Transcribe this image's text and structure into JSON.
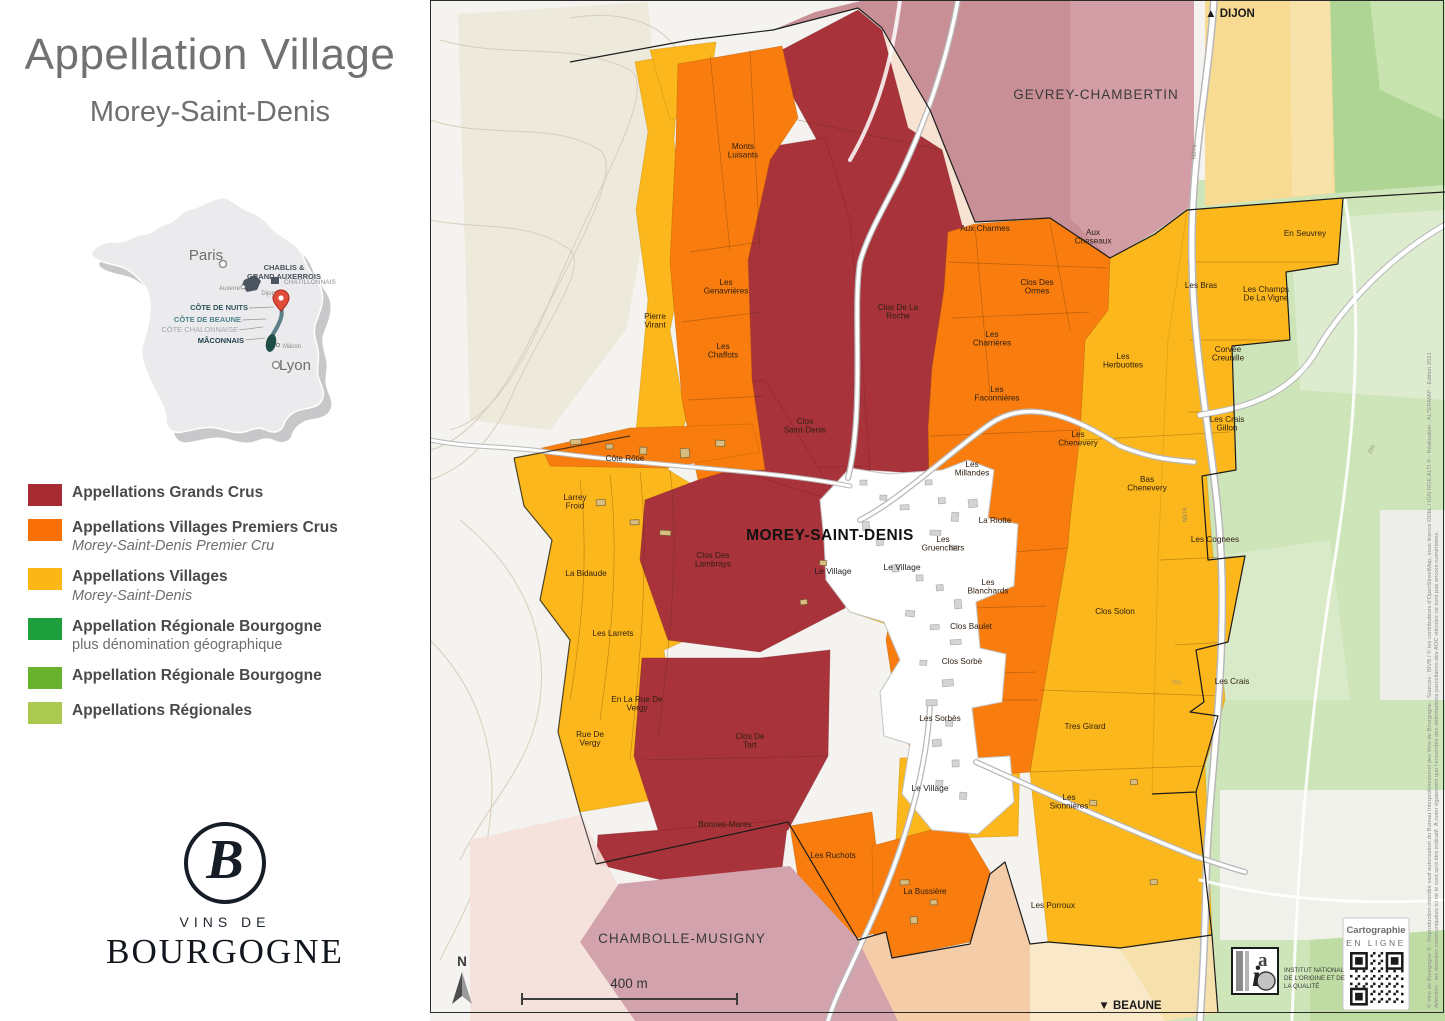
{
  "panel": {
    "title": "Appellation Village",
    "subtitle": "Morey-Saint-Denis",
    "france_map": {
      "labels": {
        "paris": "Paris",
        "lyon": "Lyon",
        "auxerre": "Auxerre",
        "dijon": "Dijon",
        "macon": "Mâcon",
        "chablis_1": "CHABLIS &",
        "chablis_2": "GRAND AUXERROIS",
        "chatillonnais": "CHÂTILLONNAIS",
        "cote_de_nuits": "CÔTE DE NUITS",
        "cote_de_beaune": "CÔTE DE BEAUNE",
        "cote_chalonnaise": "CÔTE CHALONNAISE",
        "maconnais": "MÂCONNAIS"
      }
    },
    "legend": {
      "items": [
        {
          "label": "Appellations Grands Crus",
          "sublabel": "",
          "italic": false,
          "color": "#A62B33"
        },
        {
          "label": "Appellations Villages Premiers Crus",
          "sublabel": "Morey-Saint-Denis Premier Cru",
          "italic": true,
          "color": "#F97106"
        },
        {
          "label": "Appellations Villages",
          "sublabel": "Morey-Saint-Denis",
          "italic": true,
          "color": "#FBB715"
        },
        {
          "label": "Appellation Régionale Bourgogne",
          "sublabel": "plus dénomination géographique",
          "italic": false,
          "color": "#1C9F3C"
        },
        {
          "label": "Appellation Régionale Bourgogne",
          "sublabel": "",
          "italic": false,
          "color": "#68B22D"
        },
        {
          "label": "Appellations Régionales",
          "sublabel": "",
          "italic": false,
          "color": "#ABC851"
        }
      ]
    },
    "logo": {
      "monogram": "B",
      "line1": "VINS DE",
      "line2": "BOURGOGNE"
    }
  },
  "map": {
    "nav_north": "▲ DIJON",
    "nav_south": "▼ BEAUNE",
    "scale_text": "400 m",
    "north_letter": "N",
    "communes": [
      {
        "name": "GEVREY-CHAMBERTIN",
        "x": 666,
        "y": 99,
        "size": 13.5
      },
      {
        "name": "MOREY-SAINT-DENIS",
        "x": 400,
        "y": 540,
        "size": 15.5
      },
      {
        "name": "CHAMBOLLE-MUSIGNY",
        "x": 252,
        "y": 943,
        "size": 13.5
      }
    ],
    "parcel_labels": [
      {
        "lines": [
          "Monts",
          "Luisants"
        ],
        "x": 313,
        "y": 149
      },
      {
        "lines": [
          "Pierre",
          "Virant"
        ],
        "x": 225,
        "y": 319
      },
      {
        "lines": [
          "Les",
          "Genavrières"
        ],
        "x": 296,
        "y": 285
      },
      {
        "lines": [
          "Les",
          "Chaffots"
        ],
        "x": 293,
        "y": 349
      },
      {
        "lines": [
          "Clos De La",
          "Roche"
        ],
        "x": 468,
        "y": 310
      },
      {
        "lines": [
          "Aux Charmes"
        ],
        "x": 555,
        "y": 231
      },
      {
        "lines": [
          "Aux",
          "Cheseaux"
        ],
        "x": 663,
        "y": 235
      },
      {
        "lines": [
          "Clos Des",
          "Ormes"
        ],
        "x": 607,
        "y": 285
      },
      {
        "lines": [
          "Les",
          "Charrières"
        ],
        "x": 562,
        "y": 337
      },
      {
        "lines": [
          "Les",
          "Herbuottes"
        ],
        "x": 693,
        "y": 359
      },
      {
        "lines": [
          "Les",
          "Faconnières"
        ],
        "x": 567,
        "y": 392
      },
      {
        "lines": [
          "Les",
          "Chenevery"
        ],
        "x": 648,
        "y": 437
      },
      {
        "lines": [
          "Les",
          "Millandes"
        ],
        "x": 542,
        "y": 467
      },
      {
        "lines": [
          "Bas",
          "Chenevery"
        ],
        "x": 717,
        "y": 482
      },
      {
        "lines": [
          "La Riotte"
        ],
        "x": 565,
        "y": 523
      },
      {
        "lines": [
          "Clos",
          "Saint-Denis"
        ],
        "x": 375,
        "y": 424
      },
      {
        "lines": [
          "Côte Rôtie"
        ],
        "x": 195,
        "y": 461
      },
      {
        "lines": [
          "Larrey",
          "Froid"
        ],
        "x": 145,
        "y": 500
      },
      {
        "lines": [
          "Clos Des",
          "Lambrays"
        ],
        "x": 283,
        "y": 558
      },
      {
        "lines": [
          "Les",
          "Gruenchers"
        ],
        "x": 513,
        "y": 542
      },
      {
        "lines": [
          "La Bidaude"
        ],
        "x": 156,
        "y": 576
      },
      {
        "lines": [
          "Les",
          "Blanchards"
        ],
        "x": 558,
        "y": 585
      },
      {
        "lines": [
          "Les Larrets"
        ],
        "x": 183,
        "y": 636
      },
      {
        "lines": [
          "Clos Baulet"
        ],
        "x": 541,
        "y": 629
      },
      {
        "lines": [
          "Clos Sorbè"
        ],
        "x": 532,
        "y": 664
      },
      {
        "lines": [
          "Clos Solon"
        ],
        "x": 685,
        "y": 614
      },
      {
        "lines": [
          "Les Sorbès"
        ],
        "x": 510,
        "y": 721
      },
      {
        "lines": [
          "En La Rue De",
          "Vergy"
        ],
        "x": 207,
        "y": 702
      },
      {
        "lines": [
          "Rue De",
          "Vergy"
        ],
        "x": 160,
        "y": 737
      },
      {
        "lines": [
          "Clos De",
          "Tart"
        ],
        "x": 320,
        "y": 739
      },
      {
        "lines": [
          "Tres Girard"
        ],
        "x": 655,
        "y": 729
      },
      {
        "lines": [
          "Bonnes-Mares"
        ],
        "x": 295,
        "y": 827
      },
      {
        "lines": [
          "Les Ruchots"
        ],
        "x": 403,
        "y": 858
      },
      {
        "lines": [
          "Les",
          "Sionnières"
        ],
        "x": 639,
        "y": 800
      },
      {
        "lines": [
          "La Bussière"
        ],
        "x": 495,
        "y": 894
      },
      {
        "lines": [
          "Les Porroux"
        ],
        "x": 623,
        "y": 908
      },
      {
        "lines": [
          "En Seuvrey"
        ],
        "x": 875,
        "y": 236
      },
      {
        "lines": [
          "Les Bras"
        ],
        "x": 771,
        "y": 288
      },
      {
        "lines": [
          "Les Champs",
          "De La Vigne"
        ],
        "x": 836,
        "y": 292
      },
      {
        "lines": [
          "Corvée",
          "Creunille"
        ],
        "x": 798,
        "y": 352
      },
      {
        "lines": [
          "Les Crais",
          "Gillon"
        ],
        "x": 797,
        "y": 422
      },
      {
        "lines": [
          "Les Cognees"
        ],
        "x": 785,
        "y": 542
      },
      {
        "lines": [
          "Les Crais"
        ],
        "x": 802,
        "y": 684
      }
    ],
    "village_labels": [
      {
        "text": "Le Village",
        "x": 403,
        "y": 574
      },
      {
        "text": "Le Village",
        "x": 472,
        "y": 570
      },
      {
        "text": "Le Village",
        "x": 500,
        "y": 791
      }
    ],
    "road_labels": [
      {
        "text": "N974",
        "x": 757,
        "y": 515,
        "rot": -90
      },
      {
        "text": "N974",
        "x": 766,
        "y": 152,
        "rot": -86
      }
    ],
    "contour_labels": [
      {
        "text": "250",
        "x": 943,
        "y": 450,
        "rot": -65
      },
      {
        "text": "250",
        "x": 746,
        "y": 684,
        "rot": 8
      }
    ],
    "credits_box": {
      "line1": "Cartographie",
      "line2": "EN LIGNE"
    },
    "inao": {
      "lines": [
        "INSTITUT NATIONAL",
        "DE L'ORIGINE ET DE",
        "LA QUALITÉ"
      ]
    },
    "side_credit_1": "© Vins de Bourgogne ® - Reproduction interdite sauf autorisation du Bureau Interprofessionnel des Vins de Bourgogne - Sources : BIVB / © les contributeurs d'OpenStreetMap, sous licence ODbL / IGN RGE ALTI ® - Réalisation : ALTERMAP - Édition 2021",
    "side_credit_2": "Attention : les données communiquées ici ne le sont qu'à titre indicatif. À noter également que l'ensemble des délimitations parcellaires des AOC viticoles ne sont pas encore numérisées.",
    "colors": {
      "grand_cru": "#A8333A",
      "premier_cru": "#F87D0E",
      "village": "#FBB71B",
      "gevrey_pink": "#C98F97",
      "chambolle_pink": "#D3A3AD",
      "regional_green": "#CEE5BA"
    }
  }
}
